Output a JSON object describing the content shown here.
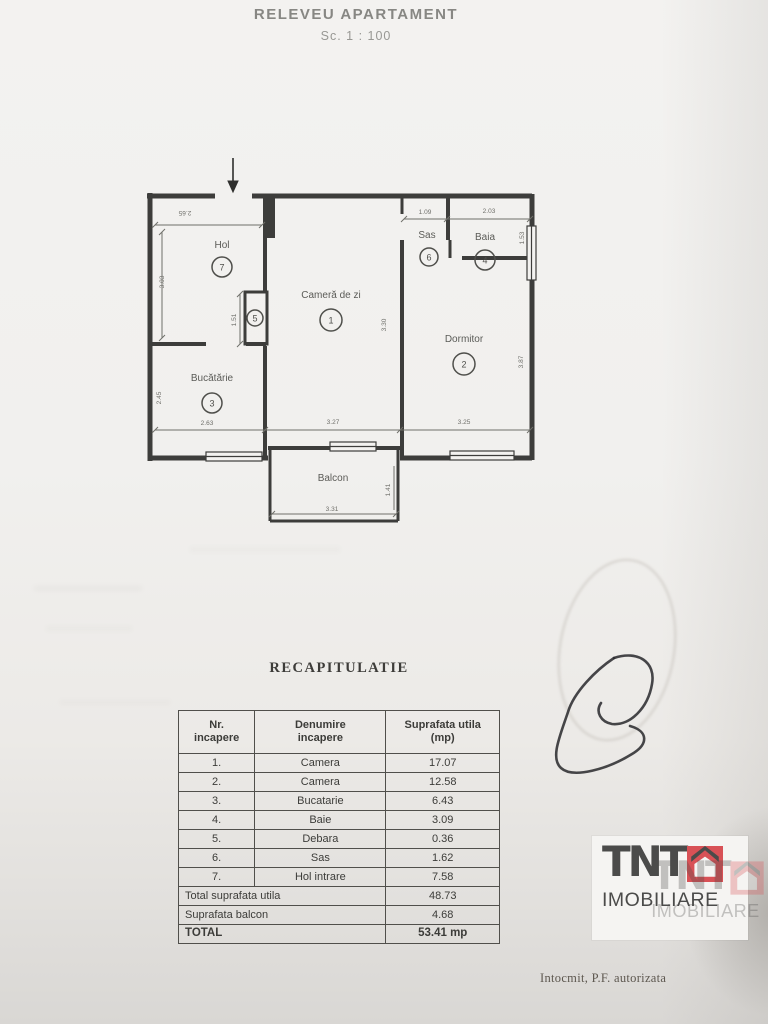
{
  "page": {
    "title": "RELEVEU APARTAMENT",
    "scale": "Sc. 1 : 100",
    "footer": "Intocmit, P.F. autorizata"
  },
  "plan": {
    "rooms": [
      {
        "name": "Cameră de zi",
        "number": "1"
      },
      {
        "name": "Dormitor",
        "number": "2"
      },
      {
        "name": "Bucătărie",
        "number": "3"
      },
      {
        "name": "Baia",
        "number": "4"
      },
      {
        "name": "Debara",
        "number": "5"
      },
      {
        "name": "Sas",
        "number": "6"
      },
      {
        "name": "Hol",
        "number": "7"
      },
      {
        "name": "Balcon",
        "number": ""
      }
    ],
    "dims": {
      "hol_w": "2.65",
      "hol_h": "3.03",
      "closet_h": "1.51",
      "sas_w": "1.09",
      "baia_w": "2.03",
      "baia_h": "1.53",
      "camera_h": "3.30",
      "dormitor_h": "3.87",
      "bucatarie_h": "2.45",
      "bucatarie_w": "2.63",
      "camera_w": "3.27",
      "dormitor_w": "3.25",
      "balcon_h": "1.41",
      "balcon_w": "3.31"
    }
  },
  "recap": {
    "heading": "RECAPITULATIE",
    "headers": [
      "Nr.\nincapere",
      "Denumire\nincapere",
      "Suprafata utila\n(mp)"
    ],
    "rows": [
      {
        "nr": "1.",
        "name": "Camera",
        "area": "17.07"
      },
      {
        "nr": "2.",
        "name": "Camera",
        "area": "12.58"
      },
      {
        "nr": "3.",
        "name": "Bucatarie",
        "area": "6.43"
      },
      {
        "nr": "4.",
        "name": "Baie",
        "area": "3.09"
      },
      {
        "nr": "5.",
        "name": "Debara",
        "area": "0.36"
      },
      {
        "nr": "6.",
        "name": "Sas",
        "area": "1.62"
      },
      {
        "nr": "7.",
        "name": "Hol intrare",
        "area": "7.58"
      }
    ],
    "summary": [
      {
        "label": "Total suprafata utila",
        "value": "48.73"
      },
      {
        "label": "Suprafata balcon",
        "value": "4.68"
      },
      {
        "label": "TOTAL",
        "value": "53.41 mp"
      }
    ]
  },
  "logo": {
    "name": "TNT",
    "sub": "IMOBILIARE",
    "accent_color": "#d85156",
    "ink_color": "#4b4b4a"
  }
}
